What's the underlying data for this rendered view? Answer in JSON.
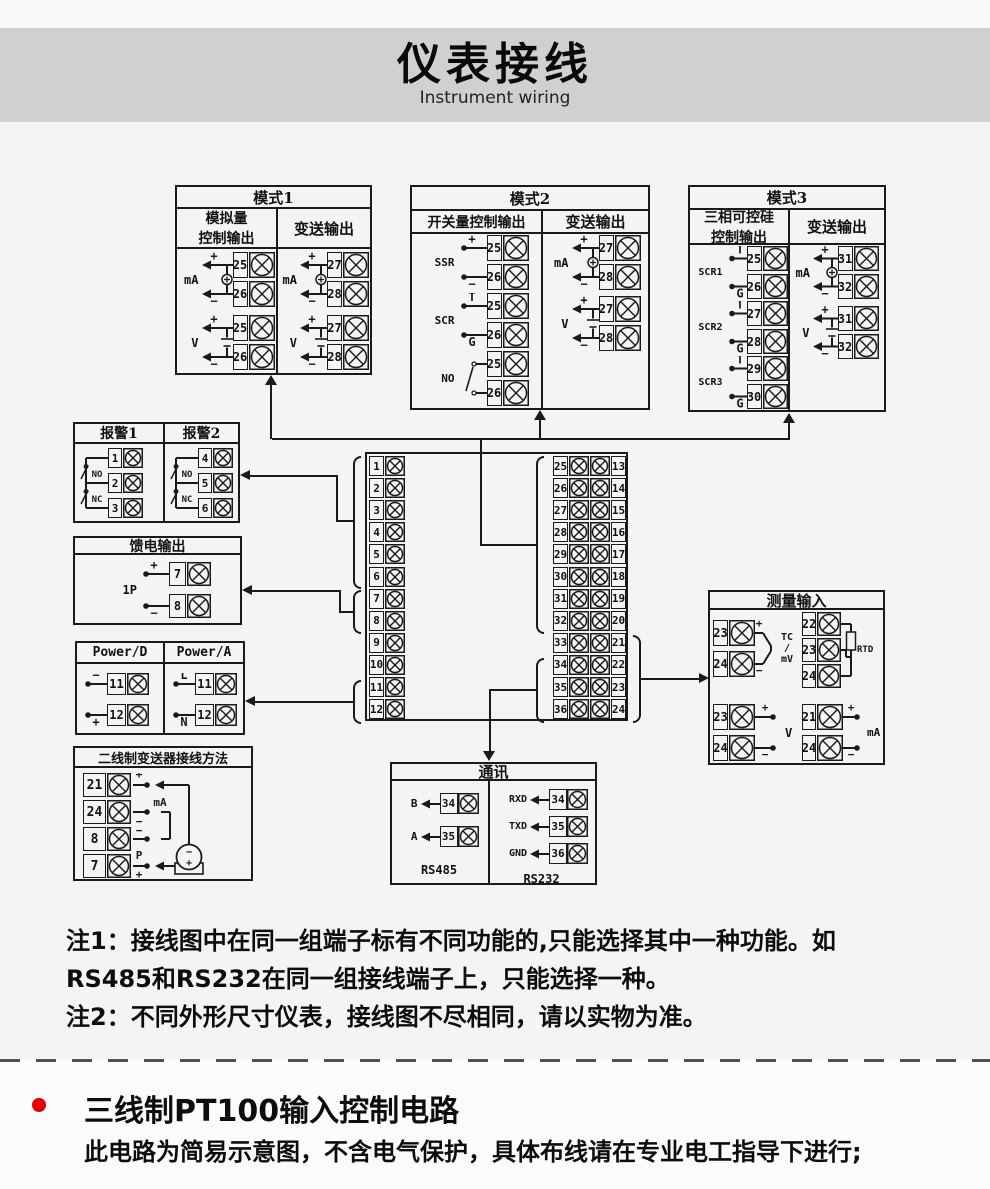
{
  "header": {
    "title": "仪表接线",
    "subtitle": "Instrument wiring"
  },
  "diagram": {
    "mode1": {
      "title": "模式1",
      "left_header": [
        "模拟量",
        "控制输出"
      ],
      "right_header": [
        "变送输出"
      ],
      "left_groups": [
        {
          "label": "mA",
          "style": "mA",
          "terminals": [
            {
              "num": "25",
              "sign": "+"
            },
            {
              "num": "26",
              "sign": "−"
            }
          ]
        },
        {
          "label": "V",
          "style": "V",
          "terminals": [
            {
              "num": "25",
              "sign": "+"
            },
            {
              "num": "26",
              "sign": "−"
            }
          ]
        }
      ],
      "right_groups": [
        {
          "label": "mA",
          "style": "mA",
          "terminals": [
            {
              "num": "27",
              "sign": "+"
            },
            {
              "num": "28",
              "sign": "−"
            }
          ]
        },
        {
          "label": "V",
          "style": "V",
          "terminals": [
            {
              "num": "27",
              "sign": "+"
            },
            {
              "num": "28",
              "sign": "−"
            }
          ]
        }
      ]
    },
    "mode2": {
      "title": "模式2",
      "left_header": [
        "开关量控制输出"
      ],
      "right_header": [
        "变送输出"
      ],
      "left_groups": [
        {
          "label": "SSR",
          "style": "dots",
          "terminals": [
            {
              "num": "25",
              "sign": "+"
            },
            {
              "num": "26",
              "sign": "−"
            }
          ]
        },
        {
          "label": "SCR",
          "style": "dots",
          "terminals": [
            {
              "num": "25",
              "sign": "T"
            },
            {
              "num": "26",
              "sign": "G"
            }
          ]
        },
        {
          "label": "NO",
          "style": "contact",
          "terminals": [
            {
              "num": "25",
              "sign": ""
            },
            {
              "num": "26",
              "sign": ""
            }
          ]
        }
      ],
      "right_groups": [
        {
          "label": "mA",
          "style": "mA",
          "terminals": [
            {
              "num": "27",
              "sign": "+"
            },
            {
              "num": "28",
              "sign": "−"
            }
          ]
        },
        {
          "label": "V",
          "style": "V",
          "terminals": [
            {
              "num": "27",
              "sign": "+"
            },
            {
              "num": "28",
              "sign": "−"
            }
          ]
        }
      ]
    },
    "mode3": {
      "title": "模式3",
      "left_header": [
        "三相可控硅",
        "控制输出"
      ],
      "right_header": [
        "变送输出"
      ],
      "left_groups": [
        {
          "label": "SCR1",
          "style": "dots",
          "terminals": [
            {
              "num": "25",
              "sign": "T"
            },
            {
              "num": "26",
              "sign": "G"
            }
          ]
        },
        {
          "label": "SCR2",
          "style": "dots",
          "terminals": [
            {
              "num": "27",
              "sign": "T"
            },
            {
              "num": "28",
              "sign": "G"
            }
          ]
        },
        {
          "label": "SCR3",
          "style": "dots",
          "terminals": [
            {
              "num": "29",
              "sign": "T"
            },
            {
              "num": "30",
              "sign": "G"
            }
          ]
        }
      ],
      "right_groups": [
        {
          "label": "mA",
          "style": "mA",
          "terminals": [
            {
              "num": "31",
              "sign": "+"
            },
            {
              "num": "32",
              "sign": "−"
            }
          ]
        },
        {
          "label": "V",
          "style": "V",
          "terminals": [
            {
              "num": "31",
              "sign": "+"
            },
            {
              "num": "32",
              "sign": "−"
            }
          ]
        }
      ]
    },
    "alarm": {
      "left_title": "报警1",
      "right_title": "报警2",
      "left_terminals": [
        "1",
        "2",
        "3"
      ],
      "right_terminals": [
        "4",
        "5",
        "6"
      ],
      "contact_labels": [
        "NO",
        "NC"
      ]
    },
    "feed": {
      "title": "馈电输出",
      "label": "1P",
      "terminals": [
        {
          "num": "7",
          "sign": "+"
        },
        {
          "num": "8",
          "sign": "−"
        }
      ]
    },
    "power": {
      "left_title": "Power/D",
      "right_title": "Power/A",
      "left_terminals": [
        {
          "num": "11",
          "sign": "−"
        },
        {
          "num": "12",
          "sign": "+"
        }
      ],
      "right_terminals": [
        {
          "num": "11",
          "sign": "L"
        },
        {
          "num": "12",
          "sign": "N"
        }
      ]
    },
    "twowire": {
      "title": "二线制变送器接线方法",
      "rows": [
        {
          "num": "21",
          "sign": "+"
        },
        {
          "num": "24",
          "sign": "−"
        },
        {
          "num": "8",
          "sign": "−"
        },
        {
          "num": "7",
          "sign": "+"
        }
      ],
      "ma_label": "mA",
      "p_label": "P",
      "transmitter_signs": [
        "−",
        "+"
      ]
    },
    "block": {
      "left": [
        "1",
        "2",
        "3",
        "4",
        "5",
        "6",
        "7",
        "8",
        "9",
        "10",
        "11",
        "12"
      ],
      "right_inner": [
        "25",
        "26",
        "27",
        "28",
        "29",
        "30",
        "31",
        "32",
        "33",
        "34",
        "35",
        "36"
      ],
      "right_outer": [
        "13",
        "14",
        "15",
        "16",
        "17",
        "18",
        "19",
        "20",
        "21",
        "22",
        "23",
        "24"
      ]
    },
    "measure": {
      "title": "测量输入",
      "tc": {
        "terminals": [
          {
            "num": "23",
            "sign": "+"
          },
          {
            "num": "24",
            "sign": "−"
          }
        ],
        "label_lines": [
          "TC",
          "/",
          "mV"
        ]
      },
      "rtd": {
        "terminals": [
          "22",
          "23",
          "24"
        ],
        "label": "RTD"
      },
      "v": {
        "terminals": [
          {
            "num": "23",
            "sign": "+"
          },
          {
            "num": "24",
            "sign": "−"
          }
        ],
        "label": "V"
      },
      "ma": {
        "terminals": [
          {
            "num": "21",
            "sign": "+"
          },
          {
            "num": "24",
            "sign": "−"
          }
        ],
        "label": "mA"
      }
    },
    "comm": {
      "title": "通讯",
      "rs485": {
        "label": "RS485",
        "rows": [
          {
            "sig": "B",
            "num": "34"
          },
          {
            "sig": "A",
            "num": "35"
          }
        ]
      },
      "rs232": {
        "label": "RS232",
        "rows": [
          {
            "sig": "RXD",
            "num": "34"
          },
          {
            "sig": "TXD",
            "num": "35"
          },
          {
            "sig": "GND",
            "num": "36"
          }
        ]
      }
    }
  },
  "notes": {
    "line1": "注1：接线图中在同一组端子标有不同功能的,只能选择其中一种功能。如",
    "line2": "RS485和RS232在同一组接线端子上，只能选择一种。",
    "line3": "注2：不同外形尺寸仪表，接线图不尽相同，请以实物为准。"
  },
  "footer": {
    "heading": "三线制PT100输入控制电路",
    "subtext": "此电路为简易示意图，不含电气保护，具体布线请在专业电工指导下进行;"
  },
  "colors": {
    "line": "#1a1a1a",
    "band": "#d0d0d0",
    "accent_red": "#e60000"
  }
}
